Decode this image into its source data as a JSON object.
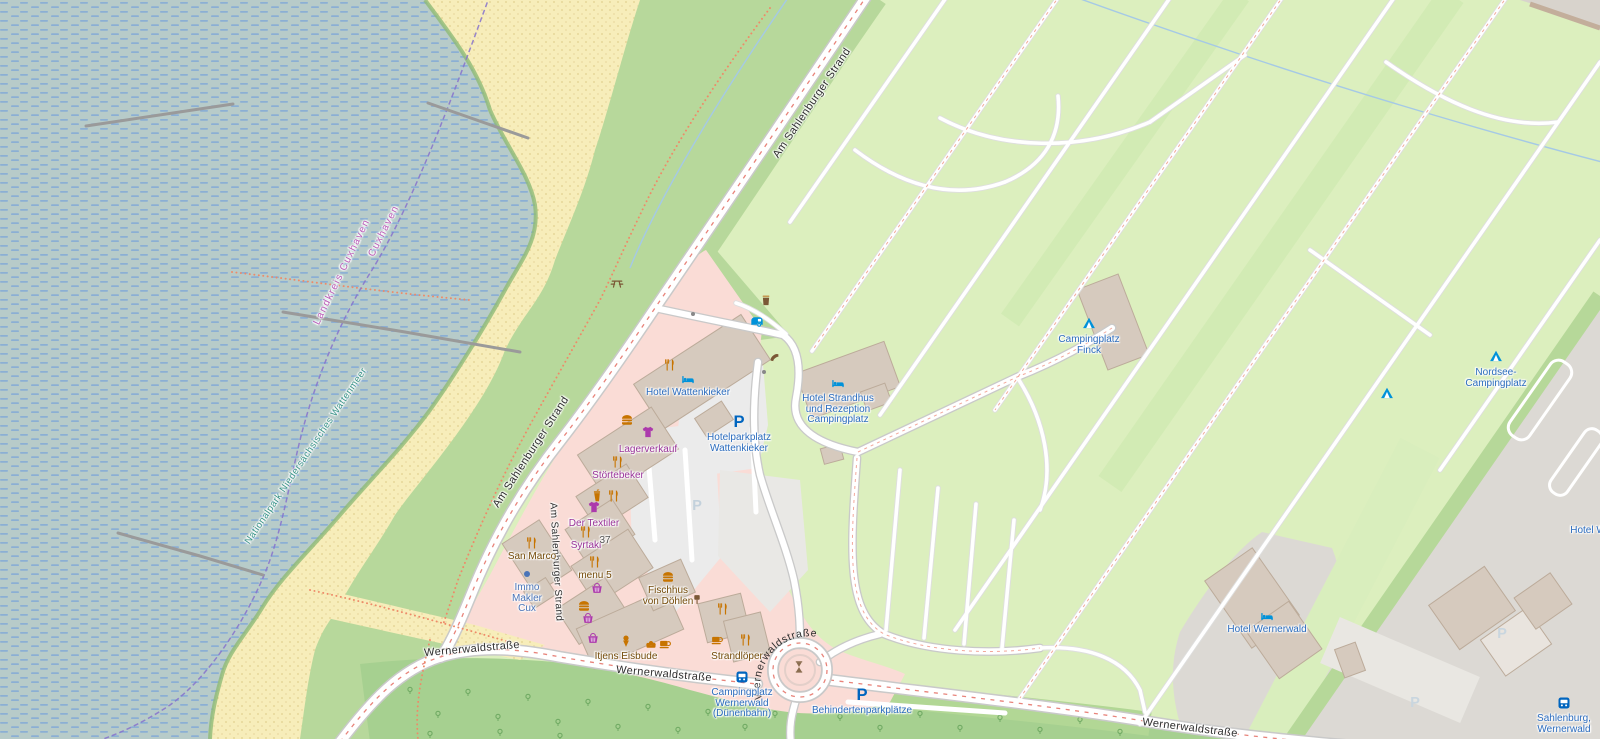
{
  "palette": {
    "water": "#b7cbc9",
    "water_dash": "#84abd6",
    "beach": "#f7edba",
    "beach_dot": "#e2d08f",
    "grass": "#b7d89b",
    "campground": "#dcefbe",
    "forest": "#a6d090",
    "retail_pink": "#fadcd6",
    "building": "#d6cabe",
    "building_outline": "#bcab9a",
    "urban_gray": "#dcd9d4",
    "parking_gray": "#ebebeb",
    "road": "#ffffff",
    "road_casing": "#c9c9c9",
    "road_red_dash": "#e8837a",
    "amenity_icon": "#c77400",
    "amenity_label": "#734a08",
    "shop_icon": "#ac39ac",
    "shop_label": "#993399",
    "tourism_icon": "#0092da",
    "tourism_label": "#2b6cbe",
    "parking_icon": "#0065bf",
    "office": "#4a74b8",
    "boundary": "#8672cc",
    "boundary_label": "#bb5cb8",
    "nationalpark_label": "#3a9488"
  },
  "icon_glyphs": {
    "parking": "P"
  },
  "roundabout_street_label": "Wernerwaldstraße",
  "street_labels": [
    {
      "id": "am-sahlenburger-strand-top",
      "label": "Am Sahlenburger Strand",
      "x": 812,
      "y": 103,
      "rot": -56,
      "size": 11
    },
    {
      "id": "am-sahlenburger-strand-mid",
      "label": "Am Sahlenburger Strand",
      "x": 531,
      "y": 452,
      "rot": -57,
      "size": 11
    },
    {
      "id": "am-sahlenburger-strand-inner",
      "label": "Am Sahlenburger Strand",
      "x": 556,
      "y": 562,
      "rot": 87,
      "size": 10
    },
    {
      "id": "wernerwaldstrasse-west-1",
      "label": "Wernerwaldstraße",
      "x": 472,
      "y": 649,
      "rot": -5,
      "size": 11
    },
    {
      "id": "wernerwaldstrasse-west-2",
      "label": "Wernerwaldstraße",
      "x": 664,
      "y": 674,
      "rot": 5,
      "size": 11
    },
    {
      "id": "wernerwaldstrasse-southeast",
      "label": "Wernerwaldstraße",
      "x": 1190,
      "y": 728,
      "rot": 7,
      "size": 11
    }
  ],
  "boundary_labels": [
    {
      "id": "landkreis-cuxhaven",
      "label": "Landkreis Cuxhaven",
      "x": 342,
      "y": 272,
      "rot": -64,
      "color": "#bb5cb8"
    },
    {
      "id": "cuxhaven",
      "label": "Cuxhaven",
      "x": 384,
      "y": 231,
      "rot": -63,
      "color": "#bb5cb8"
    }
  ],
  "area_labels": [
    {
      "id": "nationalpark",
      "label": "Nationalpark Niedersächsisches Wattenmeer",
      "x": 306,
      "y": 456,
      "rot": -56,
      "color": "#3a9488"
    }
  ],
  "pois": [
    {
      "icon": "picnic-table",
      "x": 617,
      "y": 283,
      "color": "#7b5836"
    },
    {
      "icon": "waste-basket",
      "x": 766,
      "y": 300,
      "color": "#7b5836"
    },
    {
      "icon": "caravan",
      "x": 757,
      "y": 322,
      "color": "#0092da"
    },
    {
      "icon": "telephone",
      "x": 775,
      "y": 358,
      "color": "#7b5836"
    },
    {
      "icon": "restaurant",
      "x": 670,
      "y": 365,
      "color": "#c77400"
    },
    {
      "icon": "hotel",
      "x": 688,
      "y": 379,
      "color": "#0092da",
      "label": [
        "Hotel Wattenkieker"
      ],
      "label_color": "#2b6cbe"
    },
    {
      "icon": "hotel",
      "x": 838,
      "y": 383,
      "color": "#0092da",
      "label": [
        "Hotel Strandhus",
        "und Rezeption",
        "Campingplatz"
      ],
      "label_color": "#2b6cbe",
      "dy": 2
    },
    {
      "icon": "parking",
      "x": 739,
      "y": 421,
      "color": "#0065bf",
      "label": [
        "Hotelparkplatz",
        "Wattenkieker"
      ],
      "label_color": "#2b6cbe",
      "dy": 3
    },
    {
      "icon": "parking-faint",
      "x": 697,
      "y": 505,
      "color": "#c3d1dc"
    },
    {
      "icon": "campsite",
      "x": 1089,
      "y": 323,
      "color": "#0092da",
      "label": [
        "Campingplatz",
        "Finck"
      ],
      "label_color": "#2b6cbe",
      "dy": 3
    },
    {
      "icon": "campsite",
      "x": 1496,
      "y": 356,
      "color": "#0092da",
      "label": [
        "Nordsee-",
        "Campingplatz"
      ],
      "label_color": "#2b6cbe",
      "dy": 3
    },
    {
      "icon": "campsite",
      "x": 1387,
      "y": 393,
      "color": "#0092da"
    },
    {
      "icon": "hotel",
      "x": 1267,
      "y": 616,
      "color": "#0092da",
      "label": [
        "Hotel Wernerwald"
      ],
      "label_color": "#2b6cbe"
    },
    {
      "icon": "bus-stop",
      "x": 1564,
      "y": 703,
      "color": "#0065bf",
      "label": [
        "Sahlenburg,",
        "Wernerwald"
      ],
      "label_color": "#2b6cbe",
      "dy": 2
    },
    {
      "icon": "bus-stop",
      "x": 742,
      "y": 677,
      "color": "#0065bf",
      "label": [
        "Campingplatz",
        "Wernerwald",
        "(Dünenbahn)"
      ],
      "label_color": "#2b6cbe",
      "dy": 2
    },
    {
      "icon": "parking",
      "x": 862,
      "y": 694,
      "color": "#0065bf",
      "label": [
        "Behindertenparkplätze"
      ],
      "label_color": "#2b6cbe",
      "dy": 3
    },
    {
      "icon": "artwork",
      "x": 799,
      "y": 667,
      "color": "#8a6d4f"
    },
    {
      "icon": "restaurant",
      "x": 532,
      "y": 543,
      "color": "#c77400",
      "label": [
        "San Marco"
      ],
      "label_color": "#734a08"
    },
    {
      "icon": "office-dot",
      "x": 527,
      "y": 574,
      "color": "#4a74b8",
      "label": [
        "Immo",
        "Makler",
        "Cux"
      ],
      "label_color": "#4a74b8"
    },
    {
      "icon": "fast-food",
      "x": 627,
      "y": 420,
      "color": "#c77400"
    },
    {
      "icon": "clothes",
      "x": 648,
      "y": 432,
      "color": "#ac39ac",
      "label": [
        "Lagerverkauf"
      ],
      "label_color": "#993399",
      "dy": 4
    },
    {
      "icon": "restaurant",
      "x": 618,
      "y": 462,
      "color": "#c77400",
      "label": [
        "Störtebeker"
      ],
      "label_color": "#993399"
    },
    {
      "icon": "drink-cup",
      "x": 597,
      "y": 496,
      "color": "#c77400"
    },
    {
      "icon": "restaurant",
      "x": 614,
      "y": 496,
      "color": "#c77400"
    },
    {
      "icon": "clothes",
      "x": 594,
      "y": 507,
      "color": "#ac39ac",
      "label": [
        "Der Textiler"
      ],
      "label_color": "#993399",
      "dy": 3
    },
    {
      "icon": "restaurant",
      "x": 586,
      "y": 532,
      "color": "#c77400",
      "label": [
        "Syrtaki"
      ],
      "label_color": "#993399"
    },
    {
      "label": [
        "37"
      ],
      "x": 605,
      "y": 541,
      "label_color": "#555555"
    },
    {
      "icon": "restaurant",
      "x": 595,
      "y": 562,
      "color": "#c77400",
      "label": [
        "menu 5"
      ],
      "label_color": "#734a08"
    },
    {
      "icon": "basket",
      "x": 597,
      "y": 588,
      "color": "#ac39ac"
    },
    {
      "icon": "fast-food",
      "x": 584,
      "y": 606,
      "color": "#c77400"
    },
    {
      "icon": "basket",
      "x": 588,
      "y": 618,
      "color": "#ac39ac"
    },
    {
      "icon": "basket",
      "x": 593,
      "y": 638,
      "color": "#ac39ac"
    },
    {
      "icon": "ice-cream",
      "x": 626,
      "y": 641,
      "color": "#c77400",
      "label": [
        "Itjens Eisbude"
      ],
      "label_color": "#734a08",
      "dy": 2
    },
    {
      "icon": "bakery",
      "x": 651,
      "y": 644,
      "color": "#c77400"
    },
    {
      "icon": "cafe",
      "x": 665,
      "y": 644,
      "color": "#c77400"
    },
    {
      "icon": "fast-food",
      "x": 668,
      "y": 577,
      "color": "#c77400",
      "label": [
        "Fischhus",
        "von Döhlen"
      ],
      "label_color": "#734a08"
    },
    {
      "icon": "post-box",
      "x": 697,
      "y": 599,
      "color": "#7b5836"
    },
    {
      "icon": "restaurant",
      "x": 723,
      "y": 609,
      "color": "#c77400"
    },
    {
      "icon": "cafe",
      "x": 717,
      "y": 640,
      "color": "#c77400"
    },
    {
      "icon": "restaurant",
      "x": 746,
      "y": 640,
      "color": "#c77400",
      "label": [
        "Strandlöper"
      ],
      "label_color": "#734a08",
      "dx": -9,
      "dy": 3
    },
    {
      "label": [
        "Hotel W"
      ],
      "x": 1588,
      "y": 531,
      "label_color": "#2b6cbe"
    },
    {
      "icon": "parking-faint",
      "x": 1502,
      "y": 633,
      "color": "#c9d6df"
    },
    {
      "icon": "parking-faint",
      "x": 1415,
      "y": 702,
      "color": "#c9d6df"
    },
    {
      "icon": "gate-dot",
      "x": 693,
      "y": 314,
      "color": "#888888"
    },
    {
      "icon": "gate-dot",
      "x": 764,
      "y": 372,
      "color": "#888888"
    }
  ]
}
